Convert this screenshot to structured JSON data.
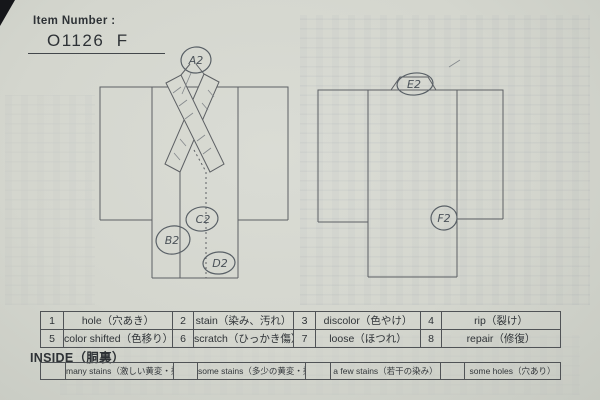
{
  "header": {
    "label": "Item Number :",
    "value": "O1126  F"
  },
  "diagrams": {
    "front": {
      "title": "kimono-front-view",
      "markers": [
        {
          "label": "A2"
        },
        {
          "label": "B2"
        },
        {
          "label": "C2"
        },
        {
          "label": "D2"
        }
      ]
    },
    "back": {
      "title": "kimono-back-view",
      "markers": [
        {
          "label": "E2"
        },
        {
          "label": "F2"
        }
      ]
    }
  },
  "legend": {
    "rows": [
      [
        {
          "num": "1",
          "label": "hole（穴あき）"
        },
        {
          "num": "2",
          "label": "stain（染み、汚れ）"
        },
        {
          "num": "3",
          "label": "discolor（色やけ）"
        },
        {
          "num": "4",
          "label": "rip（裂け）"
        }
      ],
      [
        {
          "num": "5",
          "label": "color shifted（色移り）"
        },
        {
          "num": "6",
          "label": "scratch（ひっかき傷）"
        },
        {
          "num": "7",
          "label": "loose（ほつれ）"
        },
        {
          "num": "8",
          "label": "repair（修復）"
        }
      ]
    ]
  },
  "inside": {
    "title": "INSIDE（胴裏）",
    "options": [
      {
        "label": "many stains（激しい黄変・染み）"
      },
      {
        "label": "some stains（多少の黄変・染み）"
      },
      {
        "label": "a few stains（若干の染み）"
      },
      {
        "label": "some holes（穴あり）"
      }
    ]
  },
  "colors": {
    "paper": "#d5d7cf",
    "ink": "#2e3236",
    "pencil": "#5d6064"
  }
}
